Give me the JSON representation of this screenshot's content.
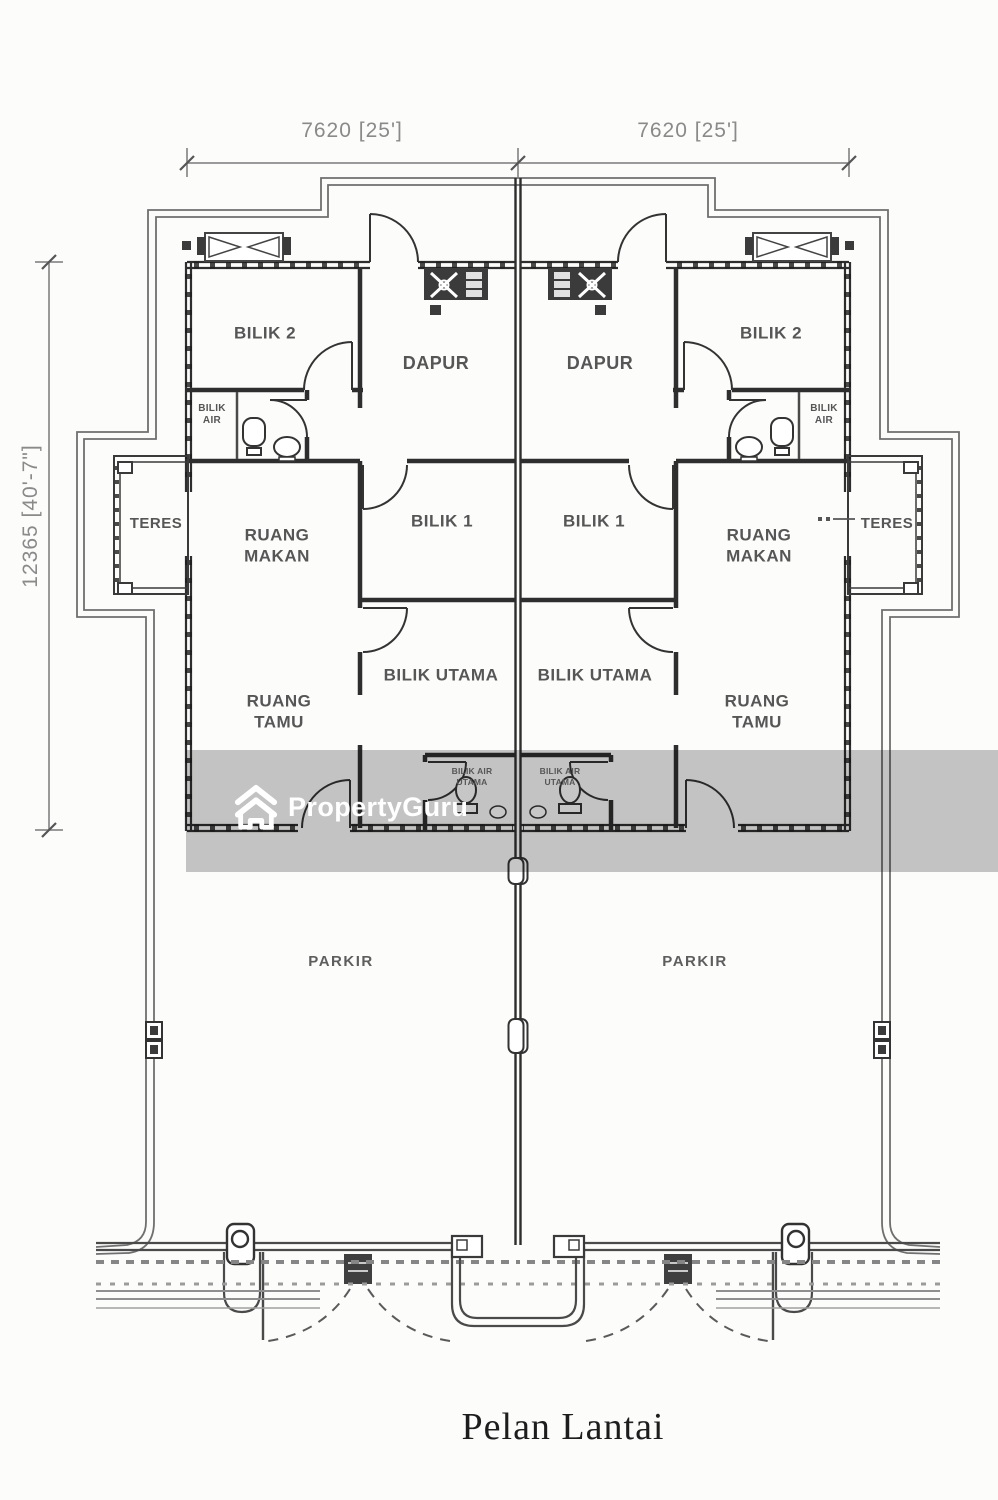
{
  "title_label": "Pelan Lantai",
  "dimensions": {
    "width_left": "7620 [25']",
    "width_right": "7620 [25']",
    "height_left": "12365 [40'-7\"]"
  },
  "rooms": {
    "left": {
      "bilik2": "BILIK 2",
      "dapur": "DAPUR",
      "bilik_air": "BILIK\nAIR",
      "teres": "TERES",
      "ruang_makan": "RUANG\nMAKAN",
      "bilik1": "BILIK 1",
      "ruang_tamu": "RUANG\nTAMU",
      "bilik_utama": "BILIK UTAMA",
      "bilik_air_utama": "BILIK AIR\nUTAMA",
      "parkir": "PARKIR"
    },
    "right": {
      "bilik2": "BILIK 2",
      "dapur": "DAPUR",
      "bilik_air": "BILIK\nAIR",
      "teres": "TERES",
      "ruang_makan": "RUANG\nMAKAN",
      "bilik1": "BILIK 1",
      "ruang_tamu": "RUANG\nTAMU",
      "bilik_utama": "BILIK UTAMA",
      "bilik_air_utama": "BILIK AIR\nUTAMA",
      "parkir": "PARKIR"
    }
  },
  "watermark": {
    "brand": "PropertyGuru"
  },
  "colors": {
    "wall": "#2e2e2e",
    "outline": "#6f6f6f",
    "watermark_band": "#c6c6c6",
    "label_text": "#565656",
    "dimension_text": "#8a8a8a"
  }
}
